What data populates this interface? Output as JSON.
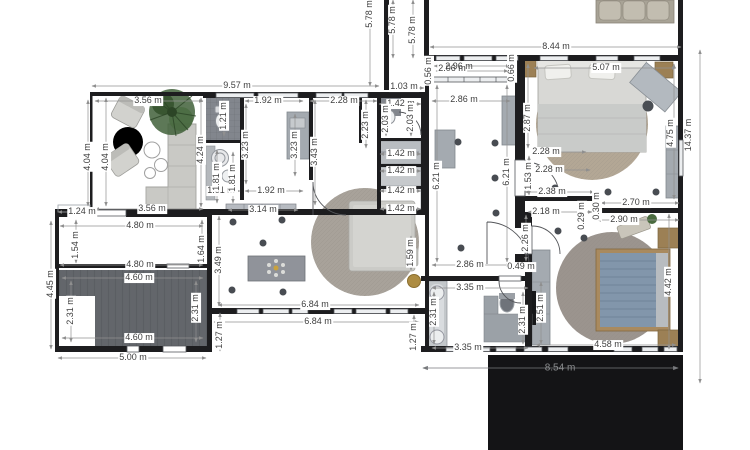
{
  "title": "floor plan",
  "unit": "m",
  "colors": {
    "walls": "#1d1d1f",
    "dimension_text": "#3e3e3e",
    "dimension_lines": "#909090",
    "terrace": "#141416",
    "garage_floor": "#63666b",
    "tile_floor": "#82868d",
    "furniture_gray": "#a4aab0",
    "rug": "#a8a29a",
    "bed_blue": "#8296ab",
    "wood": "#9c8055",
    "plant_green": "#3f6136",
    "background": "#ffffff"
  },
  "icons": {
    "ceiling_light": "dot",
    "chandelier": "star-burst",
    "plant": "green-foliage"
  },
  "dims": {
    "overall": {
      "top": "9.57 m",
      "top_gap": "1.03 m",
      "upper": "8.44 m",
      "right": "14.37 m",
      "terrace": "8.54 m",
      "garage_width": "5.00 m",
      "garage_side": "4.45 m",
      "wing_a": "5.78 m",
      "wing_b": "5.78 m",
      "wing_c": "5.78 m"
    },
    "lounge": {
      "top": "3.56 m",
      "bottom": "3.56 m",
      "left_a": "4.04 m",
      "left_b": "4.04 m",
      "right": "4.24 m"
    },
    "kitchen": {
      "top": "1.92 m",
      "bottom": "1.92 m",
      "bottom_left": "1.01 m",
      "depth_a": "3.23 m",
      "depth_b": "3.23 m",
      "wall": "3.43 m",
      "serving": "3.14 m"
    },
    "bath_top": {
      "width": "1.21 m",
      "lower_a": "1.81 m",
      "lower_b": "1.81 m"
    },
    "nook": {
      "top": "2.28 m",
      "depth": "2.23 m"
    },
    "closet": {
      "top": "1.42 m",
      "c1": "1.42 m",
      "c2": "1.42 m",
      "c3": "1.42 m",
      "c4": "1.42 m",
      "side_a": "2.03 m",
      "side_b": "2.03 m"
    },
    "hall": {
      "top_a": "2.96 m",
      "top_b": "2.06 m",
      "width_top": "2.86 m",
      "width_bottom": "2.86 m",
      "len_a": "6.21 m",
      "len_b": "6.21 m",
      "gap_l": "0.56 m",
      "gap_r": "0.66 m"
    },
    "master": {
      "width": "5.07 m",
      "left": "2.87 m",
      "door": "1.53 m",
      "in_a": "2.28 m",
      "in_b": "2.28 m",
      "bottom_a": "2.38 m",
      "bottom_b": "2.70 m",
      "wardrobe": "4.75 m",
      "step_a": "0.29 m",
      "step_b": "0.30 m"
    },
    "bedroom2": {
      "top_a": "2.18 m",
      "top_b": "2.90 m",
      "left": "2.26 m",
      "wardrobe": "2.51 m",
      "right": "4.42 m",
      "bottom": "4.58 m"
    },
    "bathroom": {
      "top": "3.35 m",
      "bottom": "3.35 m",
      "left": "2.31 m",
      "right": "2.31 m",
      "lobby": "0.49 m"
    },
    "entry": {
      "top": "4.80 m",
      "bottom": "4.80 m",
      "left": "1.54 m",
      "right": "1.64 m",
      "porch": "1.24 m"
    },
    "garage": {
      "top": "4.60 m",
      "bottom": "4.60 m",
      "left": "2.31 m",
      "right": "2.31 m"
    },
    "living": {
      "bottom_a": "6.84 m",
      "bottom_b": "6.84 m",
      "left": "3.49 m",
      "jog_l": "1.27 m",
      "jog_r": "1.27 m",
      "daybed": "1.59 m"
    }
  }
}
